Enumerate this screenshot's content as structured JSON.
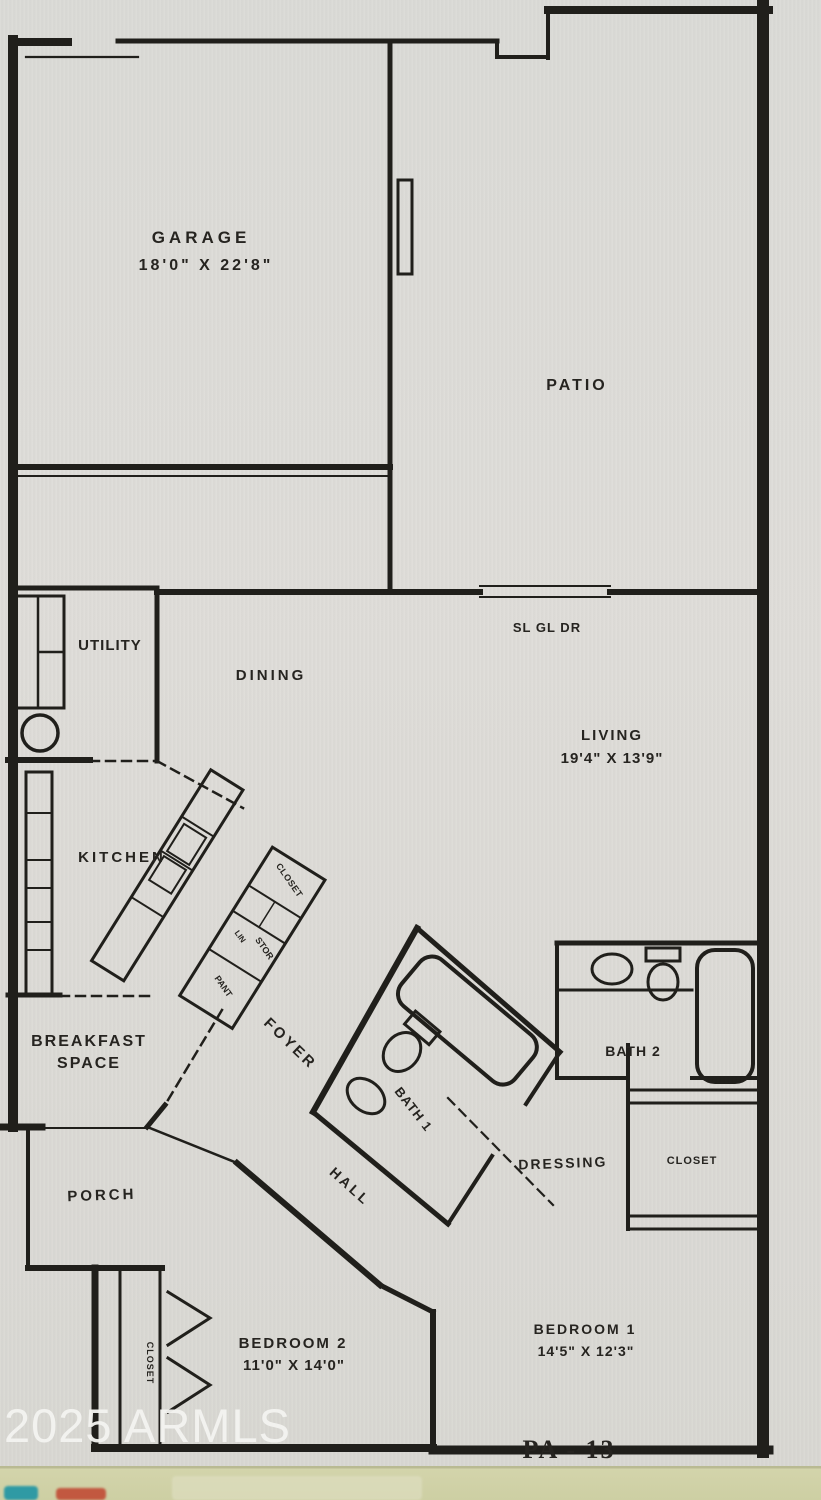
{
  "image_kind": "floor plan photo",
  "labels": {
    "garage": "GARAGE",
    "garage_dims": "18'0\" X 22'8\"",
    "patio": "PATIO",
    "utility": "UTILITY",
    "dining": "DINING",
    "sliding_door": "SL GL DR",
    "living": "LIVING",
    "living_dims": "19'4\" X 13'9\"",
    "kitchen": "KITCHEN",
    "closet_foyer": "CLOSET",
    "linen": "LIN",
    "storage": "STOR",
    "pantry": "PANT",
    "breakfast_line1": "BREAKFAST",
    "breakfast_line2": "SPACE",
    "foyer": "FOYER",
    "bath1": "BATH 1",
    "bath2": "BATH 2",
    "dressing": "DRESSING",
    "closet_dressing": "CLOSET",
    "porch": "PORCH",
    "hall": "HALL",
    "bedroom2": "BEDROOM 2",
    "bedroom2_dims": "11'0\" X 14'0\"",
    "bedroom1": "BEDROOM 1",
    "bedroom1_dims": "14'5\" X 12'3\"",
    "closet_bedroom2": "CLOSET",
    "plan_code": "PA - 13",
    "watermark": "2025 ARMLS"
  },
  "colors": {
    "paper": "#dcdbd6",
    "ink": "#201f1b",
    "watermark": "#f4f4f1",
    "film_strip": "#cdcfa3"
  }
}
